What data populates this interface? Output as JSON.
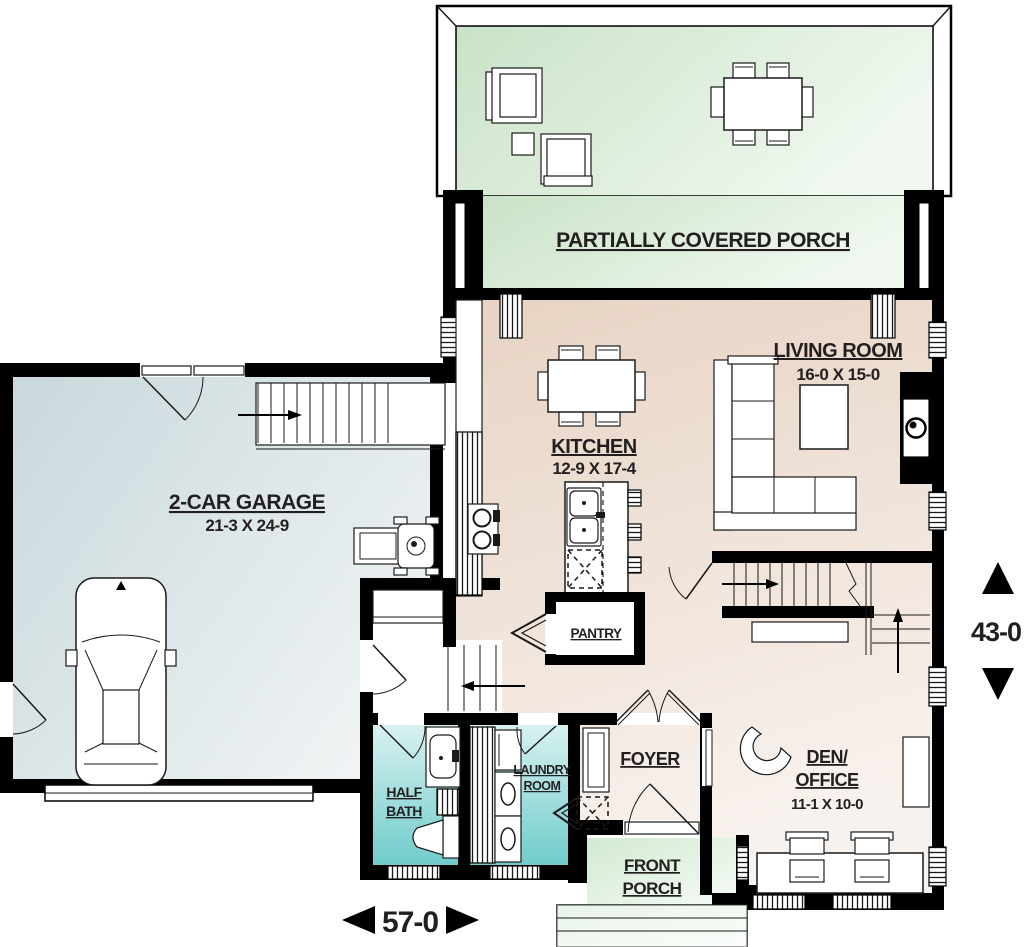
{
  "title": "First floor house plan",
  "rooms": {
    "porch": {
      "label": "PARTIALLY COVERED PORCH"
    },
    "living_room": {
      "label": "LIVING ROOM",
      "dims": "16-0 X 15-0"
    },
    "kitchen": {
      "label": "KITCHEN",
      "dims": "12-9 X 17-4"
    },
    "garage": {
      "label": "2-CAR GARAGE",
      "dims": "21-3 X 24-9"
    },
    "pantry": {
      "label": "PANTRY"
    },
    "half_bath": {
      "line1": "HALF",
      "line2": "BATH"
    },
    "laundry": {
      "line1": "LAUNDRY",
      "line2": "ROOM"
    },
    "foyer": {
      "label": "FOYER"
    },
    "front_porch": {
      "line1": "FRONT",
      "line2": "PORCH"
    },
    "den_office": {
      "line1": "DEN/",
      "line2": "OFFICE",
      "dims": "11-1 X 10-0"
    }
  },
  "dims": {
    "width": "57-0",
    "height": "43-0"
  },
  "colors": {
    "wall": "#000000",
    "text": "#231f20",
    "porch_green_dark": "#c9e2c7",
    "porch_green_light": "#f0f8ef",
    "interior_beige_dark": "#e7d3c3",
    "interior_beige_light": "#f8f2ee",
    "garage_blue_dark": "#c9d8dc",
    "garage_blue_light": "#eff3f4",
    "bath_teal_dark": "#6fcccb",
    "bath_teal_light": "#d8f1f0",
    "front_porch_dark": "#d2e9d2",
    "front_porch_light": "#f6fbf6"
  }
}
